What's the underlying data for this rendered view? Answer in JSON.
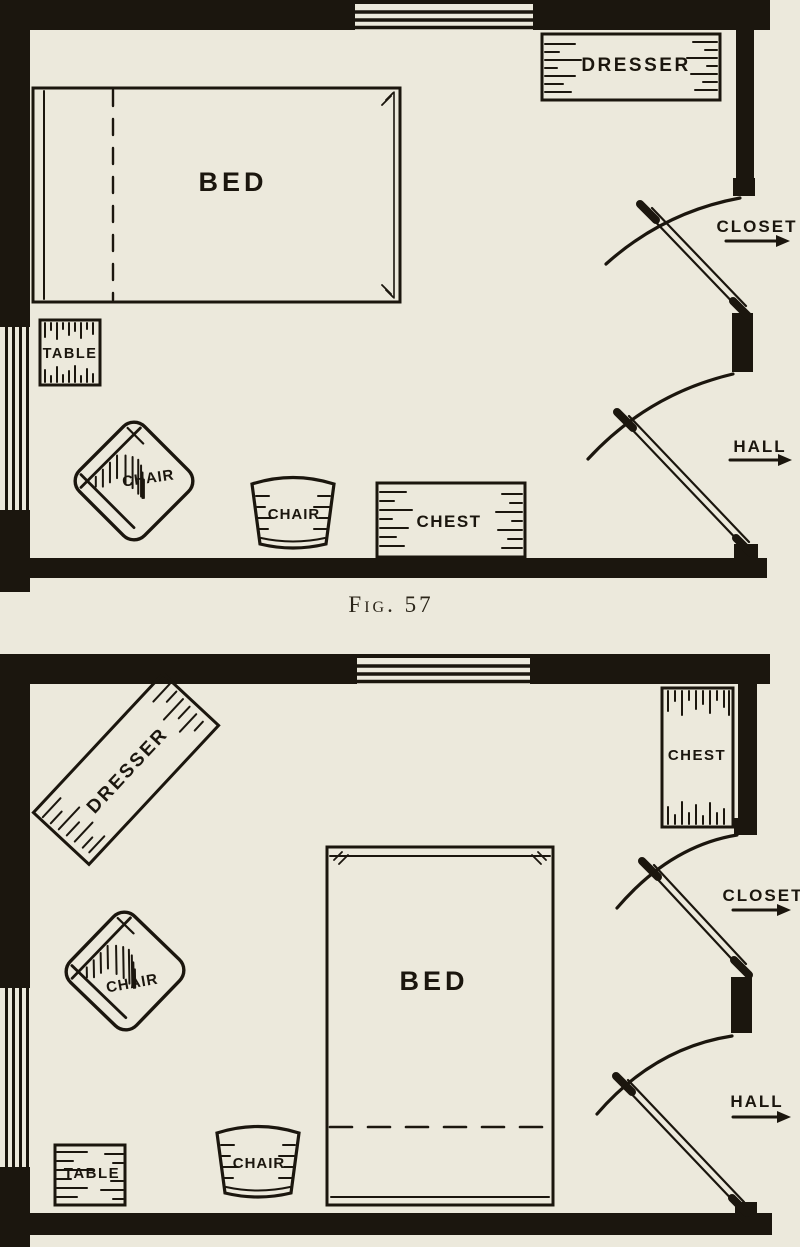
{
  "figure": {
    "caption": "Fig. 57"
  },
  "colors": {
    "paper": "#ece9dc",
    "ink": "#1b160e"
  },
  "plan_top": {
    "bed_label": "BED",
    "dresser_label": "DRESSER",
    "table_label": "TABLE",
    "armchair_label": "CHAIR",
    "side_chair_label": "CHAIR",
    "chest_label": "CHEST",
    "closet_label": "CLOSET",
    "hall_label": "HALL"
  },
  "plan_bottom": {
    "bed_label": "BED",
    "dresser_label": "DRESSER",
    "table_label": "TABLE",
    "armchair_label": "CHAIR",
    "side_chair_label": "CHAIR",
    "chest_label": "CHEST",
    "closet_label": "CLOSET",
    "hall_label": "HALL"
  }
}
